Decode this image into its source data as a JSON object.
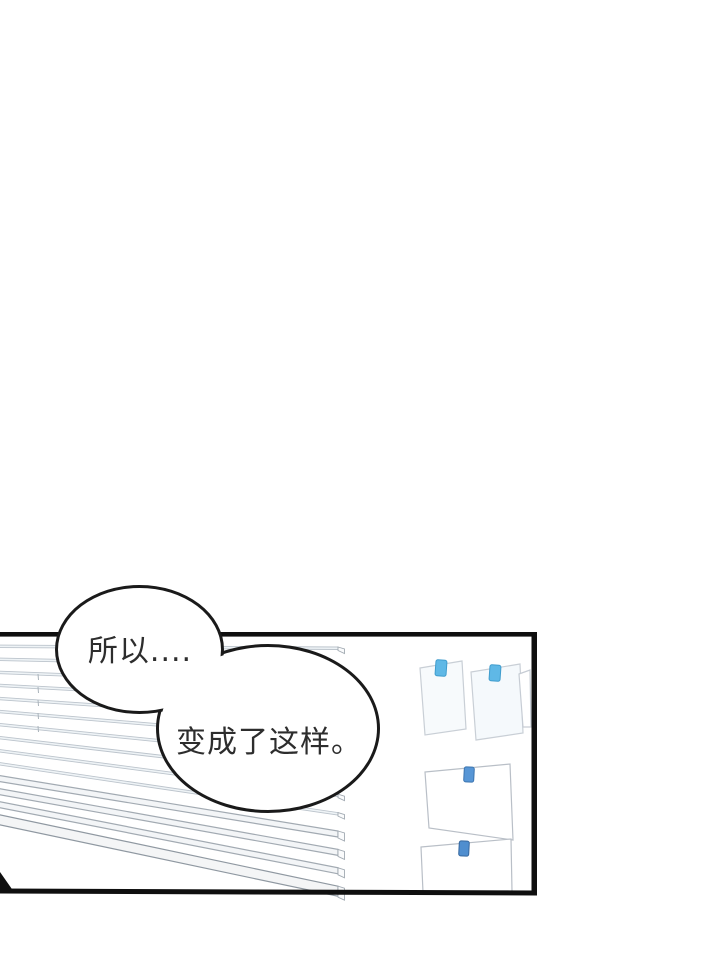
{
  "page": {
    "background": "#ffffff"
  },
  "panel": {
    "border_color": "#0f0f0f"
  },
  "bubbles": [
    {
      "name": "speech-bubble-1",
      "text": "所以...."
    },
    {
      "name": "speech-bubble-2",
      "text": "变成了这样。"
    }
  ],
  "scene": {
    "bubble_outline": "#1a1a1a",
    "text_color": "#2d2d2d",
    "blinds": {
      "slat_fill": "#eef3f6",
      "slat_stroke": "#bcc4cc",
      "thick_fill": "#f3f5f7",
      "thick_stroke": "#a2aab2",
      "rail_fill": "#f4f5f6",
      "rail_stroke": "#8f98a1",
      "cap_fill": "#fafbfc",
      "cord_stroke": "#aab3bb"
    },
    "papers": [
      {
        "name": "pinned-paper",
        "fill": "#f7fafc",
        "stroke": "#c9cfd6",
        "tape_fill": "#5fb8e6",
        "tape_stroke": "#3f9ccd"
      },
      {
        "name": "pinned-paper",
        "fill": "#f5f9fc",
        "stroke": "#c9cfd6",
        "tape_fill": "#5fb8e6",
        "tape_stroke": "#3f9ccd"
      },
      {
        "name": "pinned-paper-partial",
        "fill": "#ffffff",
        "stroke": "#c6ccd4"
      },
      {
        "name": "pinned-paper",
        "fill": "#ffffff",
        "stroke": "#b9bfc7",
        "tape_fill": "#5796d6",
        "tape_stroke": "#3b74af"
      },
      {
        "name": "pinned-paper",
        "fill": "#ffffff",
        "stroke": "#b9bfc7",
        "tape_fill": "#4f8ecf",
        "tape_stroke": "#35679e"
      }
    ]
  }
}
